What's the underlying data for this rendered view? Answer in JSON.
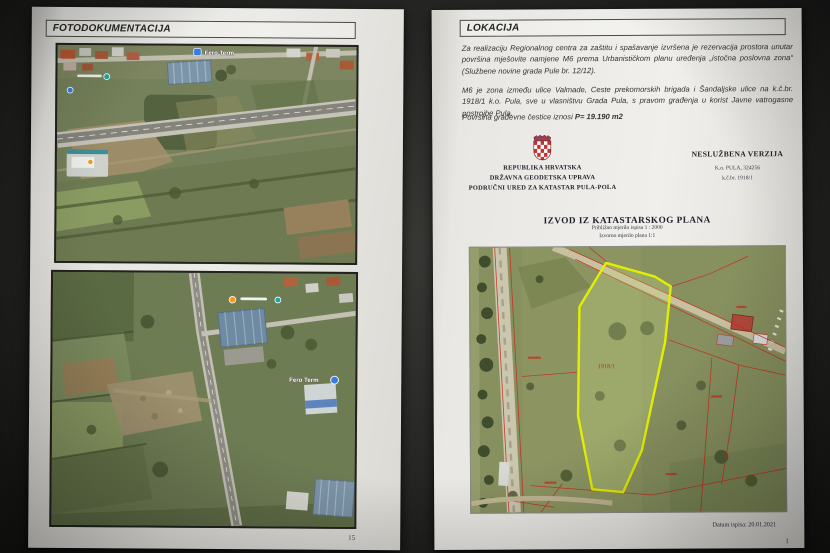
{
  "left_page": {
    "header": "FOTODOKUMENTACIJA",
    "page_number": "15",
    "photo1": {
      "pin_label": "Fero Term"
    },
    "photo2": {
      "pin_label": "Fero Term"
    }
  },
  "right_page": {
    "header": "LOKACIJA",
    "para1": "Za realizaciju Regionalnog centra za zaštitu i spašavanje izvršena je rezervacija prostora unutar površina mješovite namjene M6 prema Urbanističkom planu uređenja „istočna poslovna zona“ (Službene novine grada Pule br. 12/12).",
    "para2": "M6 je zona između ulice Valmade, Ceste prekomorskih brigada i Šandaljske ulice na k.č.br. 1918/1 k.o. Pula, sve u vlasništvu Grada Pula, s pravom građenja u korist Javne vatrogasne postrojbe Pula.",
    "para3_label": "Površina građevne čestice iznosi",
    "para3_value": "P= 19.190 m2",
    "authority": {
      "line1": "REPUBLIKA HRVATSKA",
      "line2": "DRŽAVNA GEODETSKA UPRAVA",
      "line3": "PODRUČNI URED ZA KATASTAR PULA-POLA"
    },
    "version_label": "NESLUŽBENA VERZIJA",
    "ko_line": "K.o. PULA, 324256",
    "kc_line": "k.č.br. 1918/1",
    "map_title": "IZVOD IZ KATASTARSKOG PLANA",
    "map_scale1": "Približno mjerilo ispisa 1 : 2000",
    "map_scale2": "Izvorno mjerilo plana 1:1",
    "parcel_label": "1918/1",
    "print_date": "Datum ispisa: 20.01.2021",
    "page_number": "1"
  },
  "colors": {
    "parcel_outline_yellow": "#e4ef00",
    "cadastral_red": "#c5301f",
    "paper": "#e9e8e4"
  }
}
